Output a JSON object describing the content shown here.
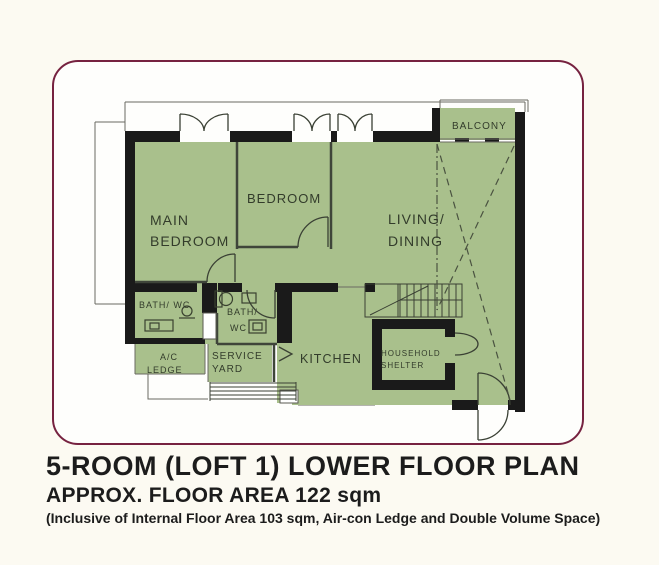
{
  "colors": {
    "page_bg": "#fcfaf2",
    "border": "#762240",
    "room_fill": "#a9c08c",
    "wall": "#1a1a1a",
    "label": "#333c2b"
  },
  "plan": {
    "rooms": {
      "main_bedroom": {
        "line1": "MAIN",
        "line2": "BEDROOM"
      },
      "bedroom": {
        "label": "BEDROOM"
      },
      "living_dining": {
        "line1": "LIVING/",
        "line2": "DINING"
      },
      "balcony": {
        "label": "BALCONY"
      },
      "bath1": {
        "label": "BATH/ WC"
      },
      "bath2": {
        "line1": "BATH/",
        "line2": "WC"
      },
      "ac_ledge": {
        "line1": "A/C",
        "line2": "LEDGE"
      },
      "service_yard": {
        "line1": "SERVICE",
        "line2": "YARD"
      },
      "kitchen": {
        "label": "KITCHEN"
      },
      "household_shelter": {
        "line1": "HOUSEHOLD",
        "line2": "SHELTER"
      }
    }
  },
  "caption": {
    "title": "5-ROOM (LOFT 1) LOWER FLOOR PLAN",
    "subtitle": "APPROX. FLOOR AREA 122 sqm",
    "note": "(Inclusive of Internal Floor Area 103 sqm, Air-con Ledge and Double Volume Space)"
  }
}
